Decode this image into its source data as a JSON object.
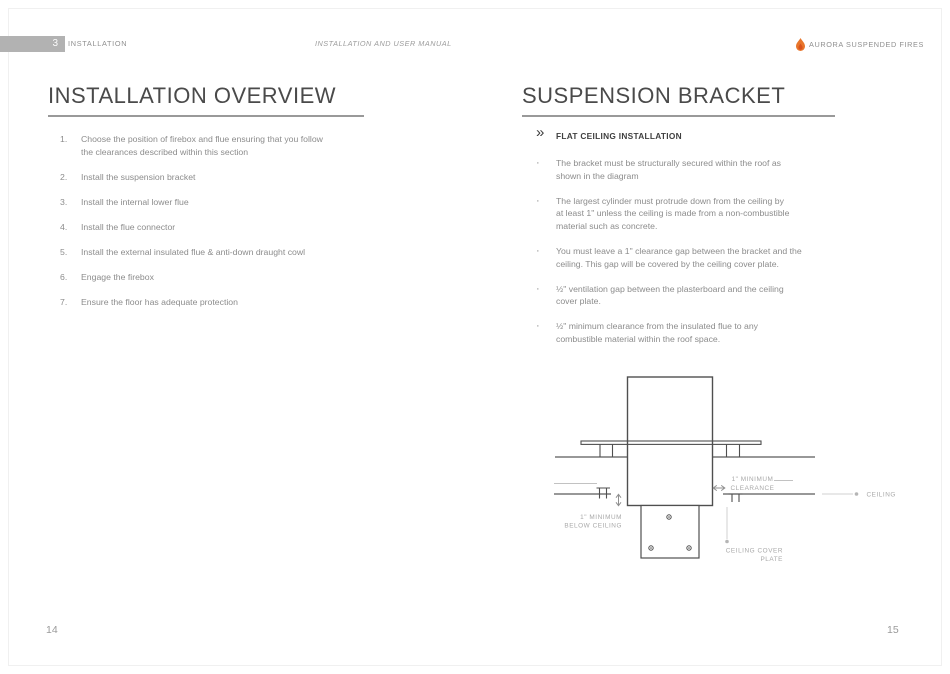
{
  "header": {
    "section_number": "3",
    "section_label": "INSTALLATION",
    "manual_title": "INSTALLATION AND USER MANUAL",
    "brand_name": "AURORA SUSPENDED FIRES",
    "flame_color": "#e8762c"
  },
  "left_page": {
    "title": "INSTALLATION OVERVIEW",
    "steps": [
      {
        "num": "1.",
        "text": "Choose the position of firebox and flue ensuring that you follow\nthe clearances described within this section"
      },
      {
        "num": "2.",
        "text": "Install the suspension bracket"
      },
      {
        "num": "3.",
        "text": "Install the internal lower flue"
      },
      {
        "num": "4.",
        "text": "Install the flue connector"
      },
      {
        "num": "5.",
        "text": "Install the external insulated flue & anti-down draught cowl"
      },
      {
        "num": "6.",
        "text": "Engage the firebox"
      },
      {
        "num": "7.",
        "text": "Ensure the floor has adequate protection"
      }
    ],
    "page_number": "14"
  },
  "right_page": {
    "title": "SUSPENSION BRACKET",
    "chevron_glyph": "»",
    "section_heading": "FLAT CEILING INSTALLATION",
    "bullet_glyph": "·",
    "bullets": [
      "The bracket must be structurally secured within the roof as\nshown in the diagram",
      "The largest cylinder must protrude down from the ceiling by\nat least 1\" unless the ceiling is made from a non-combustible\nmaterial such as concrete.",
      "You must leave a 1\" clearance gap between the bracket and the\nceiling. This gap will be covered by the ceiling cover plate.",
      "½\" ventilation gap between the plasterboard and the ceiling\ncover plate.",
      "½\" minimum clearance from the insulated flue to any\ncombustible material within the roof space."
    ],
    "diagram": {
      "labels": {
        "clearance": [
          "1\" MINIMUM",
          "CLEARANCE"
        ],
        "below_ceiling": [
          "1\" MINIMUM",
          "BELOW CEILING"
        ],
        "ceiling": "CEILING",
        "cover_plate": [
          "CEILING COVER",
          "PLATE"
        ]
      }
    },
    "page_number": "15"
  }
}
